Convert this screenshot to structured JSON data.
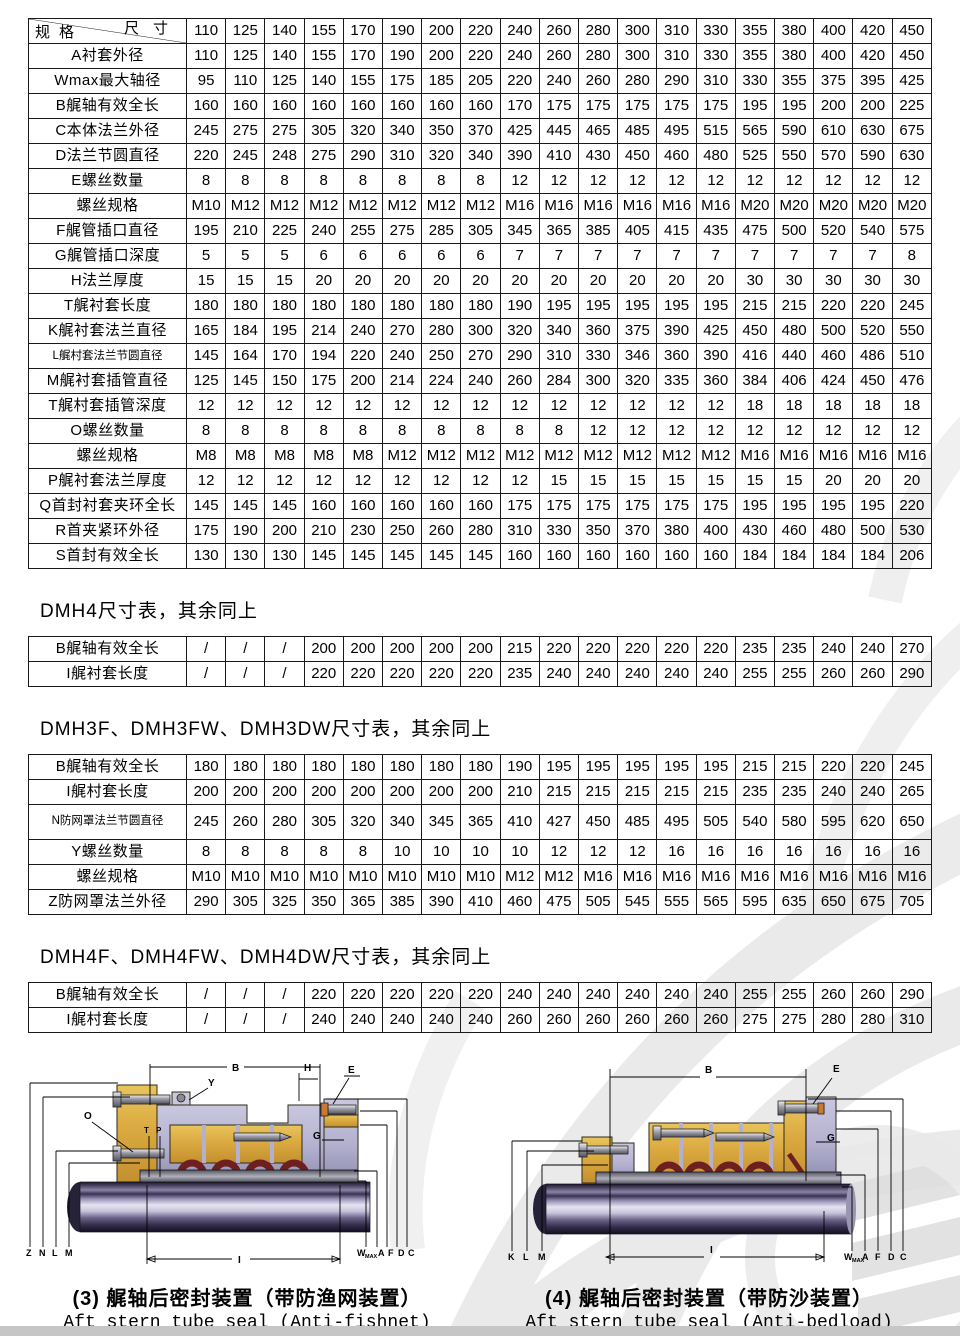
{
  "main_table": {
    "corner_top": "尺寸",
    "corner_bottom": "规格",
    "columns": [
      "110",
      "125",
      "140",
      "155",
      "170",
      "190",
      "200",
      "220",
      "240",
      "260",
      "280",
      "300",
      "310",
      "330",
      "355",
      "380",
      "400",
      "420",
      "450"
    ],
    "rows": [
      {
        "label": "A衬套外径",
        "values": [
          "110",
          "125",
          "140",
          "155",
          "170",
          "190",
          "200",
          "220",
          "240",
          "260",
          "280",
          "300",
          "310",
          "330",
          "355",
          "380",
          "400",
          "420",
          "450"
        ]
      },
      {
        "label": "Wmax最大轴径",
        "values": [
          "95",
          "110",
          "125",
          "140",
          "155",
          "175",
          "185",
          "205",
          "220",
          "240",
          "260",
          "280",
          "290",
          "310",
          "330",
          "355",
          "375",
          "395",
          "425"
        ]
      },
      {
        "label": "B艉轴有效全长",
        "values": [
          "160",
          "160",
          "160",
          "160",
          "160",
          "160",
          "160",
          "160",
          "170",
          "175",
          "175",
          "175",
          "175",
          "175",
          "195",
          "195",
          "200",
          "200",
          "225"
        ]
      },
      {
        "label": "C本体法兰外径",
        "values": [
          "245",
          "275",
          "275",
          "305",
          "320",
          "340",
          "350",
          "370",
          "425",
          "445",
          "465",
          "485",
          "495",
          "515",
          "565",
          "590",
          "610",
          "630",
          "675"
        ]
      },
      {
        "label": "D法兰节圆直径",
        "values": [
          "220",
          "245",
          "248",
          "275",
          "290",
          "310",
          "320",
          "340",
          "390",
          "410",
          "430",
          "450",
          "460",
          "480",
          "525",
          "550",
          "570",
          "590",
          "630"
        ]
      },
      {
        "label": "E螺丝数量",
        "values": [
          "8",
          "8",
          "8",
          "8",
          "8",
          "8",
          "8",
          "8",
          "12",
          "12",
          "12",
          "12",
          "12",
          "12",
          "12",
          "12",
          "12",
          "12",
          "12"
        ]
      },
      {
        "label": "螺丝规格",
        "values": [
          "M10",
          "M12",
          "M12",
          "M12",
          "M12",
          "M12",
          "M12",
          "M12",
          "M16",
          "M16",
          "M16",
          "M16",
          "M16",
          "M16",
          "M20",
          "M20",
          "M20",
          "M20",
          "M20"
        ]
      },
      {
        "label": "F艉管插口直径",
        "values": [
          "195",
          "210",
          "225",
          "240",
          "255",
          "275",
          "285",
          "305",
          "345",
          "365",
          "385",
          "405",
          "415",
          "435",
          "475",
          "500",
          "520",
          "540",
          "575"
        ]
      },
      {
        "label": "G艉管插口深度",
        "values": [
          "5",
          "5",
          "5",
          "6",
          "6",
          "6",
          "6",
          "6",
          "7",
          "7",
          "7",
          "7",
          "7",
          "7",
          "7",
          "7",
          "7",
          "7",
          "8"
        ]
      },
      {
        "label": "H法兰厚度",
        "values": [
          "15",
          "15",
          "15",
          "20",
          "20",
          "20",
          "20",
          "20",
          "20",
          "20",
          "20",
          "20",
          "20",
          "20",
          "30",
          "30",
          "30",
          "30",
          "30"
        ]
      },
      {
        "label": "T艉衬套长度",
        "values": [
          "180",
          "180",
          "180",
          "180",
          "180",
          "180",
          "180",
          "180",
          "190",
          "195",
          "195",
          "195",
          "195",
          "195",
          "215",
          "215",
          "220",
          "220",
          "245"
        ]
      },
      {
        "label": "K艉衬套法兰直径",
        "values": [
          "165",
          "184",
          "195",
          "214",
          "240",
          "270",
          "280",
          "300",
          "320",
          "340",
          "360",
          "375",
          "390",
          "425",
          "450",
          "480",
          "500",
          "520",
          "550"
        ]
      },
      {
        "label": "L艉村套法兰节圆直径",
        "values": [
          "145",
          "164",
          "170",
          "194",
          "220",
          "240",
          "250",
          "270",
          "290",
          "310",
          "330",
          "346",
          "360",
          "390",
          "416",
          "440",
          "460",
          "486",
          "510"
        ]
      },
      {
        "label": "M艉衬套插管直径",
        "values": [
          "125",
          "145",
          "150",
          "175",
          "200",
          "214",
          "224",
          "240",
          "260",
          "284",
          "300",
          "320",
          "335",
          "360",
          "384",
          "406",
          "424",
          "450",
          "476"
        ]
      },
      {
        "label": "T艉村套插管深度",
        "values": [
          "12",
          "12",
          "12",
          "12",
          "12",
          "12",
          "12",
          "12",
          "12",
          "12",
          "12",
          "12",
          "12",
          "12",
          "18",
          "18",
          "18",
          "18",
          "18"
        ]
      },
      {
        "label": "O螺丝数量",
        "values": [
          "8",
          "8",
          "8",
          "8",
          "8",
          "8",
          "8",
          "8",
          "8",
          "8",
          "12",
          "12",
          "12",
          "12",
          "12",
          "12",
          "12",
          "12",
          "12"
        ]
      },
      {
        "label": "螺丝规格",
        "values": [
          "M8",
          "M8",
          "M8",
          "M8",
          "M8",
          "M12",
          "M12",
          "M12",
          "M12",
          "M12",
          "M12",
          "M12",
          "M12",
          "M12",
          "M16",
          "M16",
          "M16",
          "M16",
          "M16"
        ]
      },
      {
        "label": "P艉衬套法兰厚度",
        "values": [
          "12",
          "12",
          "12",
          "12",
          "12",
          "12",
          "12",
          "12",
          "12",
          "15",
          "15",
          "15",
          "15",
          "15",
          "15",
          "15",
          "20",
          "20",
          "20"
        ]
      },
      {
        "label": "Q首封衬套夹环全长",
        "values": [
          "145",
          "145",
          "145",
          "160",
          "160",
          "160",
          "160",
          "160",
          "175",
          "175",
          "175",
          "175",
          "175",
          "175",
          "195",
          "195",
          "195",
          "195",
          "220"
        ]
      },
      {
        "label": "R首夹紧环外径",
        "values": [
          "175",
          "190",
          "200",
          "210",
          "230",
          "250",
          "260",
          "280",
          "310",
          "330",
          "350",
          "370",
          "380",
          "400",
          "430",
          "460",
          "480",
          "500",
          "530"
        ]
      },
      {
        "label": "S首封有效全长",
        "values": [
          "130",
          "130",
          "130",
          "145",
          "145",
          "145",
          "145",
          "145",
          "160",
          "160",
          "160",
          "160",
          "160",
          "160",
          "184",
          "184",
          "184",
          "184",
          "206"
        ]
      }
    ]
  },
  "sections": [
    {
      "heading": "DMH4尺寸表，其余同上",
      "rows": [
        {
          "label": "B艉轴有效全长",
          "values": [
            "/",
            "/",
            "/",
            "200",
            "200",
            "200",
            "200",
            "200",
            "215",
            "220",
            "220",
            "220",
            "220",
            "220",
            "235",
            "235",
            "240",
            "240",
            "270"
          ]
        },
        {
          "label": "I艉衬套长度",
          "values": [
            "/",
            "/",
            "/",
            "220",
            "220",
            "220",
            "220",
            "220",
            "235",
            "240",
            "240",
            "240",
            "240",
            "240",
            "255",
            "255",
            "260",
            "260",
            "290"
          ]
        }
      ]
    },
    {
      "heading": "DMH3F、DMH3FW、DMH3DW尺寸表，其余同上",
      "rows": [
        {
          "label": "B艉轴有效全长",
          "values": [
            "180",
            "180",
            "180",
            "180",
            "180",
            "180",
            "180",
            "180",
            "190",
            "195",
            "195",
            "195",
            "195",
            "195",
            "215",
            "215",
            "220",
            "220",
            "245"
          ]
        },
        {
          "label": "I艉村套长度",
          "values": [
            "200",
            "200",
            "200",
            "200",
            "200",
            "200",
            "200",
            "200",
            "210",
            "215",
            "215",
            "215",
            "215",
            "215",
            "235",
            "235",
            "240",
            "240",
            "265"
          ]
        },
        {
          "label": "N防网罩法兰节圆直径",
          "two_line": true,
          "values": [
            "245",
            "260",
            "280",
            "305",
            "320",
            "340",
            "345",
            "365",
            "410",
            "427",
            "450",
            "485",
            "495",
            "505",
            "540",
            "580",
            "595",
            "620",
            "650"
          ]
        },
        {
          "label": "Y螺丝数量",
          "values": [
            "8",
            "8",
            "8",
            "8",
            "8",
            "10",
            "10",
            "10",
            "10",
            "12",
            "12",
            "12",
            "16",
            "16",
            "16",
            "16",
            "16",
            "16",
            "16"
          ]
        },
        {
          "label": "螺丝规格",
          "values": [
            "M10",
            "M10",
            "M10",
            "M10",
            "M10",
            "M10",
            "M10",
            "M10",
            "M12",
            "M12",
            "M16",
            "M16",
            "M16",
            "M16",
            "M16",
            "M16",
            "M16",
            "M16",
            "M16"
          ]
        },
        {
          "label": "Z防网罩法兰外径",
          "values": [
            "290",
            "305",
            "325",
            "350",
            "365",
            "385",
            "390",
            "410",
            "460",
            "475",
            "505",
            "545",
            "555",
            "565",
            "595",
            "635",
            "650",
            "675",
            "705"
          ]
        }
      ]
    },
    {
      "heading": "DMH4F、DMH4FW、DMH4DW尺寸表，其余同上",
      "rows": [
        {
          "label": "B艉轴有效全长",
          "values": [
            "/",
            "/",
            "/",
            "220",
            "220",
            "220",
            "220",
            "220",
            "240",
            "240",
            "240",
            "240",
            "240",
            "240",
            "255",
            "255",
            "260",
            "260",
            "290"
          ]
        },
        {
          "label": "I艉村套长度",
          "values": [
            "/",
            "/",
            "/",
            "240",
            "240",
            "240",
            "240",
            "240",
            "260",
            "260",
            "260",
            "260",
            "260",
            "260",
            "275",
            "275",
            "280",
            "280",
            "310"
          ]
        }
      ]
    }
  ],
  "diagrams": {
    "left": {
      "caption_zh": "(3) 艉轴后密封装置（带防渔网装置）",
      "caption_en": "Aft stern tube seal (Anti-fishnet)",
      "labels": {
        "b": "B",
        "y": "Y",
        "h": "H",
        "e": "E",
        "o": "O",
        "t": "T",
        "p": "P",
        "g": "G",
        "z": "Z",
        "n": "N",
        "l": "L",
        "m": "M",
        "i": "I",
        "w": "W",
        "wmax": "MAX",
        "a": "A",
        "f": "F",
        "d": "D",
        "c": "C"
      }
    },
    "right": {
      "caption_zh": "(4) 艉轴后密封装置（带防沙装置）",
      "caption_en": "Aft stern tube seal (Anti-bedload)",
      "labels": {
        "b": "B",
        "e": "E",
        "g": "G",
        "k": "K",
        "l": "L",
        "m": "M",
        "i": "I",
        "w": "W",
        "wmax": "MAX",
        "a": "A",
        "f": "F",
        "d": "D",
        "c": "C"
      }
    }
  },
  "colors": {
    "table_border": "#1a1a1a",
    "housing_yellow": "#d9a73e",
    "metal_lavender": "#b3b1cf",
    "seal_red": "#6e2020",
    "shaft_dark": "#2a2540",
    "watermark_gray": "#e6e6e6",
    "bottom_strip": "#c6c6c6"
  }
}
